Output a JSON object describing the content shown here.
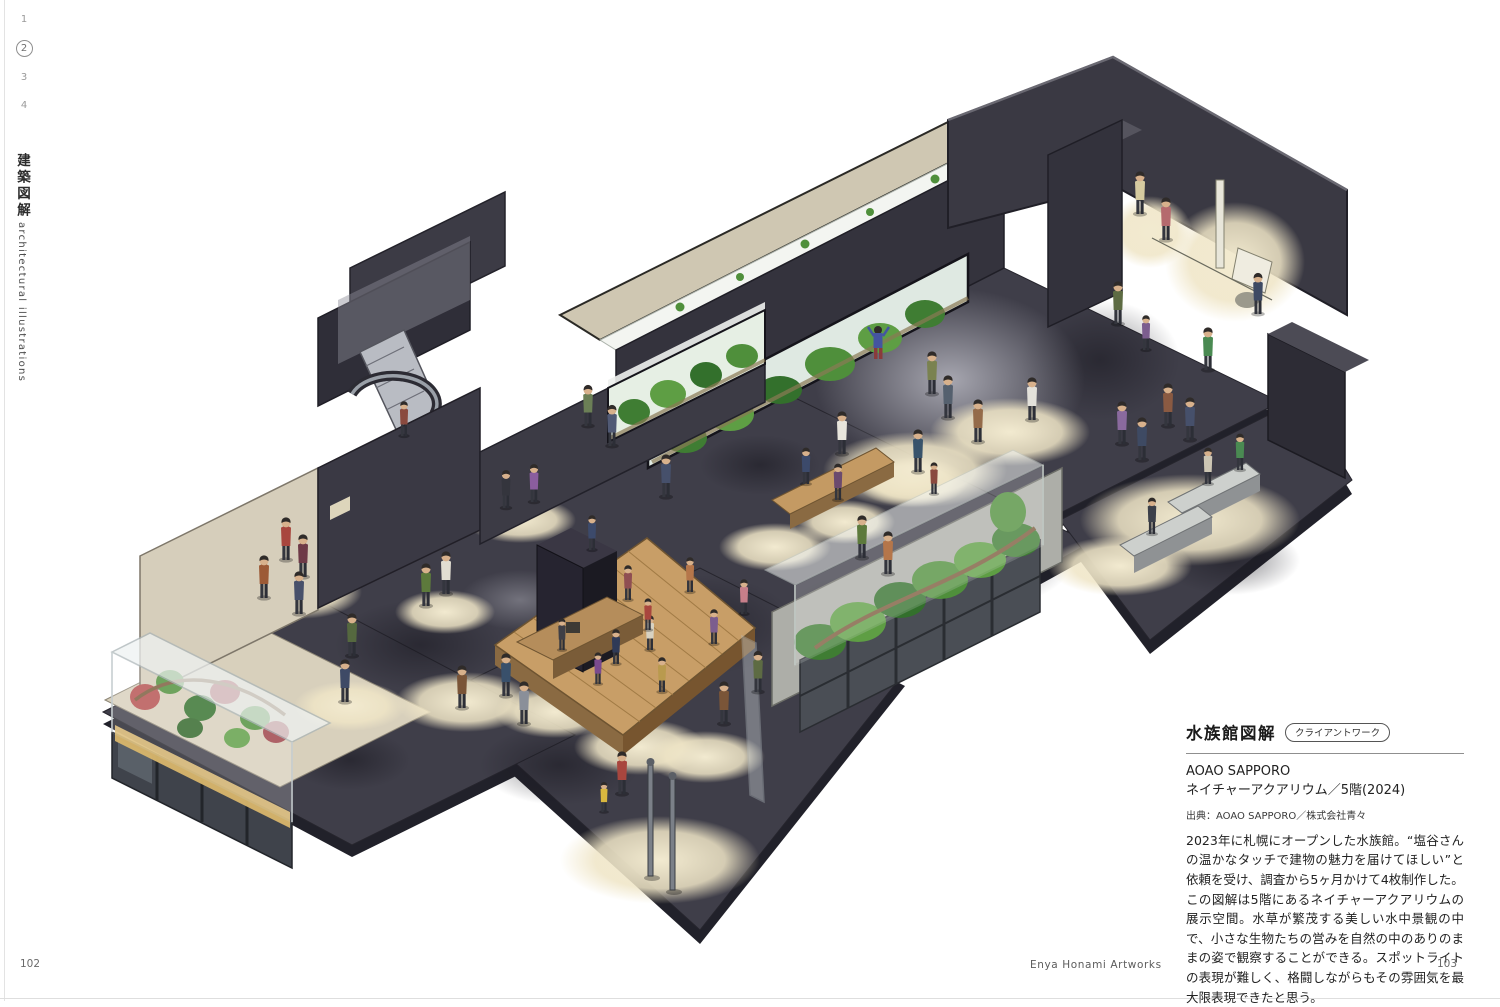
{
  "page": {
    "left_page_number": "102",
    "right_page_number": "103",
    "footer_center": "Enya Honami Artworks"
  },
  "sidebar": {
    "chapter_numbers": [
      "1",
      "2",
      "3",
      "4"
    ],
    "active_chapter": "2",
    "series_title_ja": "建築図解",
    "series_title_en": "architectural illustrations"
  },
  "caption": {
    "title": "水族館図解",
    "badge": "クライアントワーク",
    "work_title": "AOAO SAPPORO",
    "work_subtitle": "ネイチャーアクアリウム／5階(2024)",
    "credit": "出典：AOAO SAPPORO／株式会社青々",
    "body_1": "2023年に札幌にオープンした水族館。“塩谷さんの温かなタッチで建物の魅力を届けてほしい”と依頼を受け、調査から5ヶ月かけて4枚制作した。",
    "body_2": "この図解は5階にあるネイチャーアクアリウムの展示空間。水草が繁茂する美しい水中景観の中で、小さな生物たちの営みを自然の中のありのままの姿で観察することができる。スポットライトの表現が難しく、格闘しながらもその雰囲気を最大限表現できたと思う。"
  },
  "illustration": {
    "alt": "Isometric watercolor cutaway of the aquarium's 5th-floor nature-aquarium hall: dark rooms lit by cream spotlights, planted glass tanks, a central wooden deck, an escalator and many small visitors",
    "palette": {
      "floor_dark": "#3f3e49",
      "wall_dark": "#35343e",
      "wall_beige": "#d6cebb",
      "spotlight_cream": "#f2ead0",
      "plant_green": "#4f8f3b",
      "plant_red": "#b5504f",
      "deck_wood": "#c69e67"
    }
  }
}
